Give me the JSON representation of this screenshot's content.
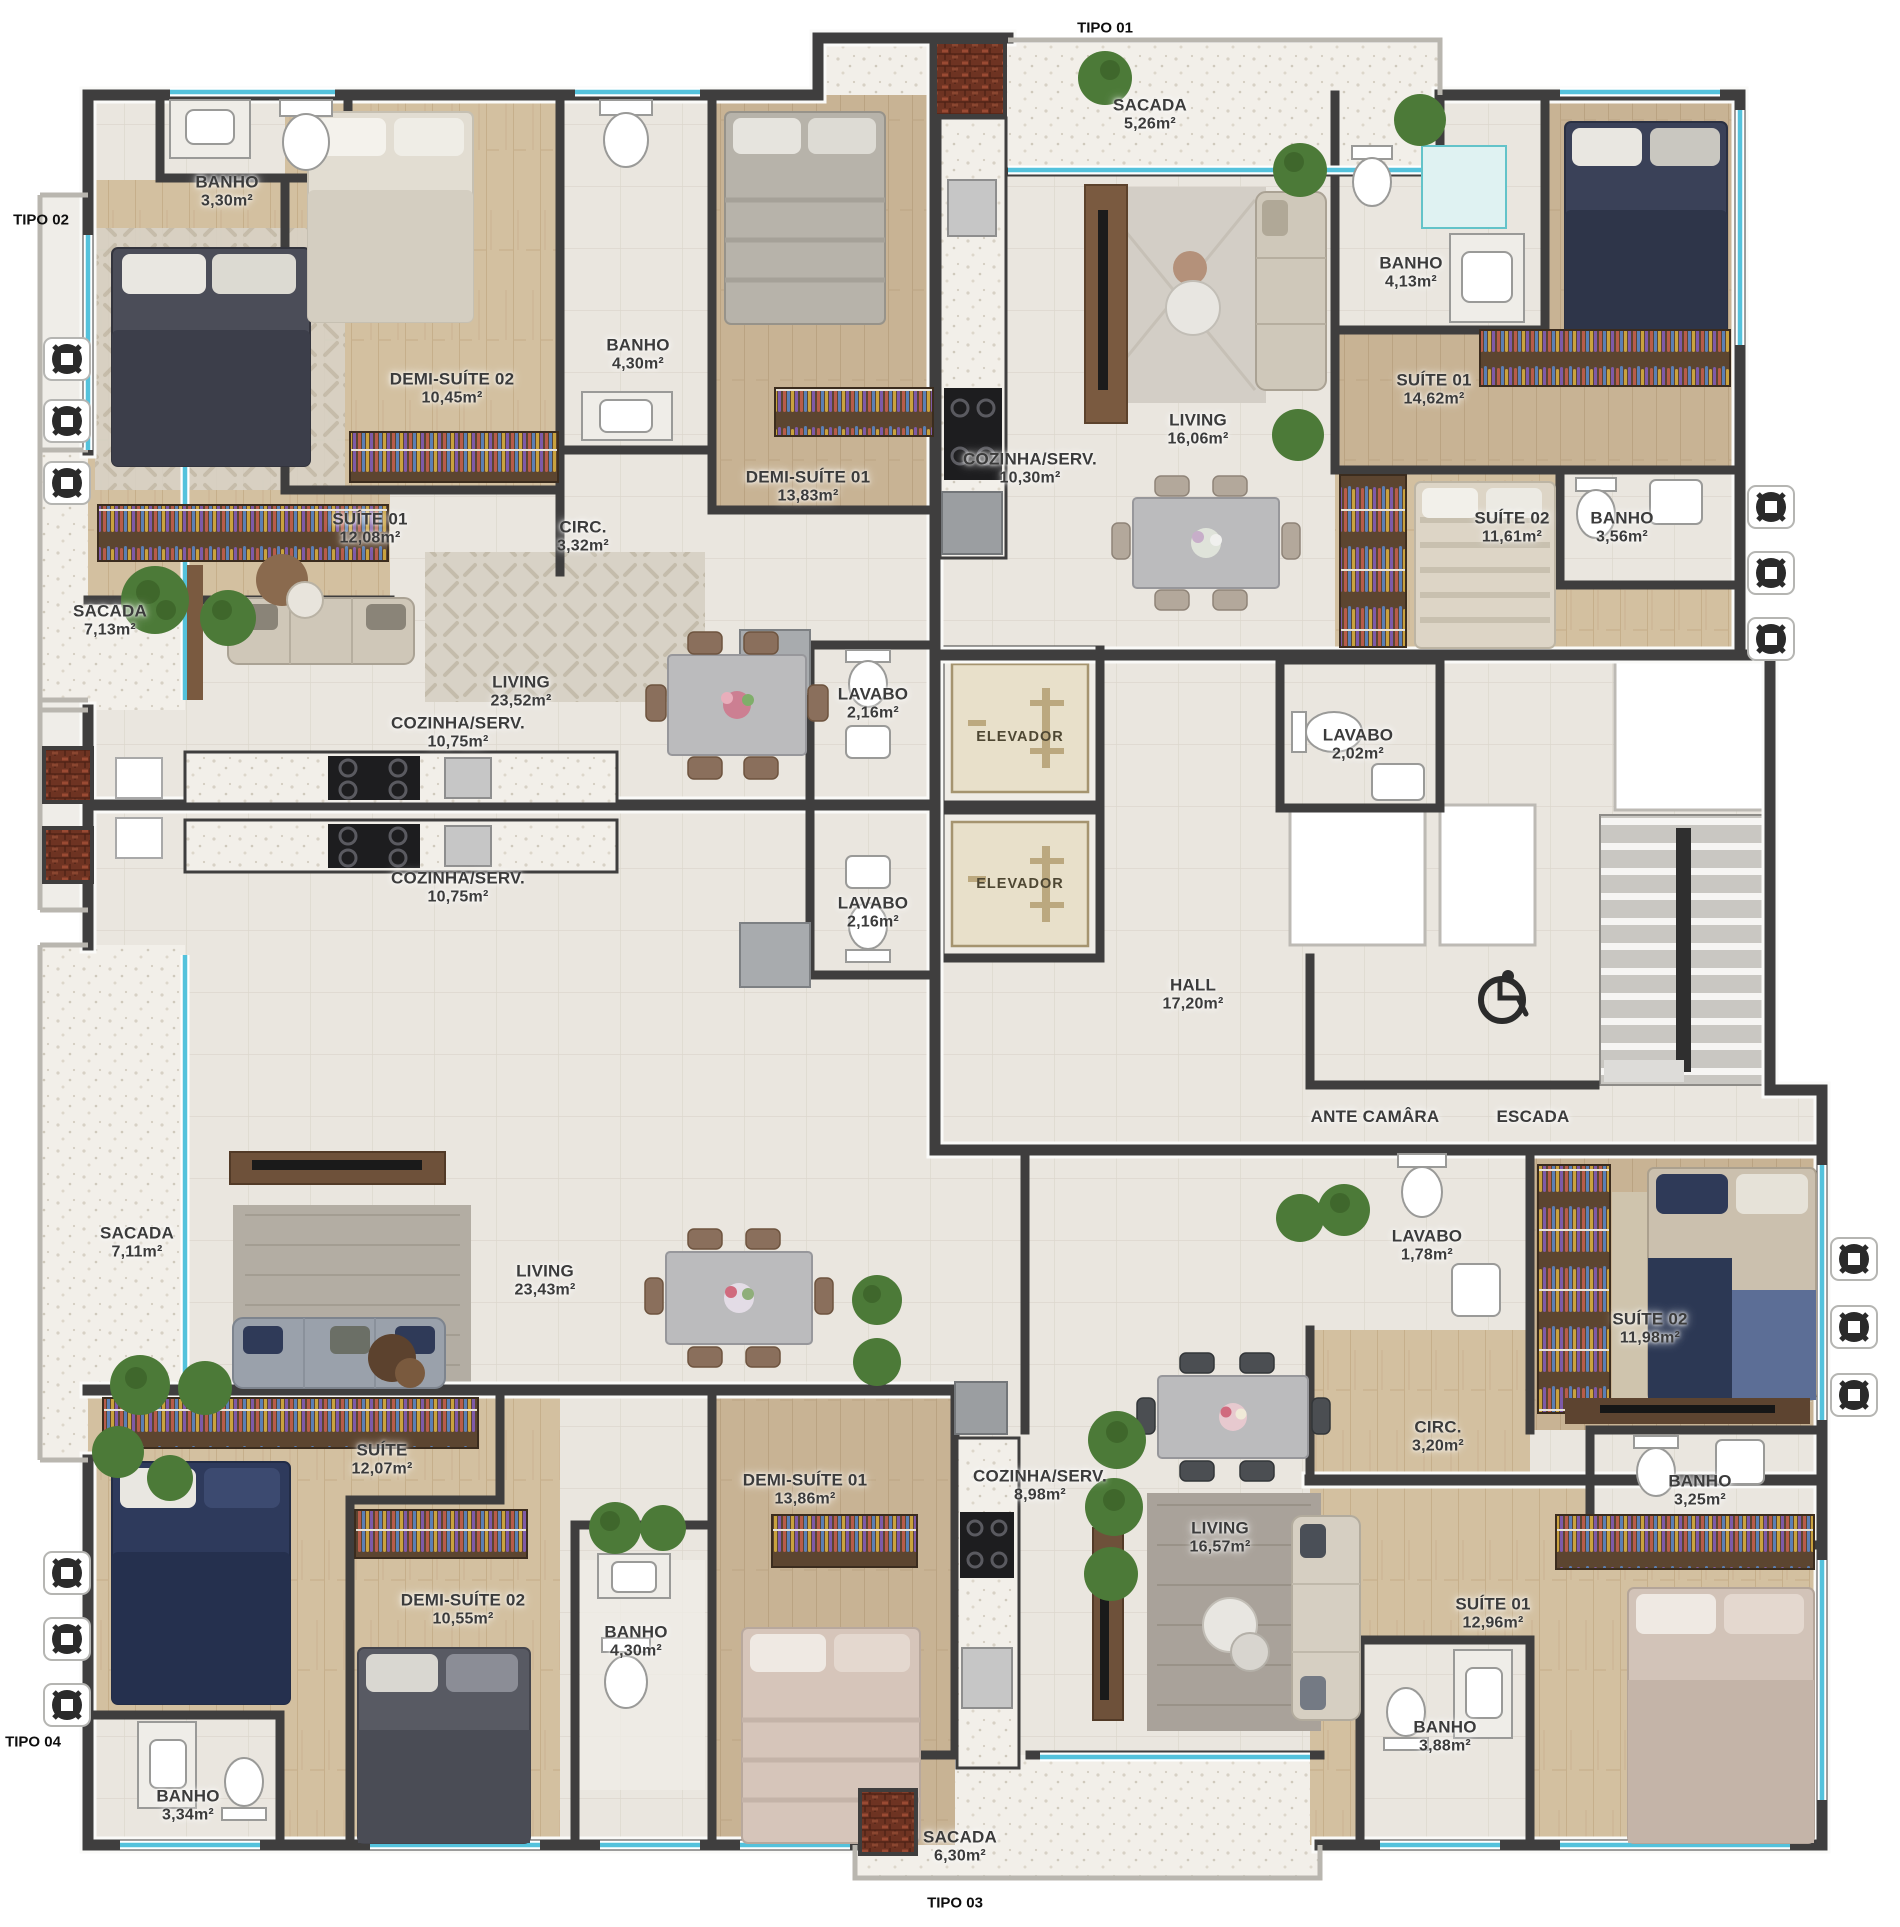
{
  "title": "Planta do pavimento - apartamentos Tipo 01 a Tipo 04",
  "colors": {
    "wall": "#3f3e3e",
    "tile_floor": "#eae6df",
    "wood_floor": "#d3c0a0",
    "balcony_floor": "#f2efe9",
    "window_glass": "#54c2dc",
    "label_text": "#3b3b3b",
    "elevator_cab": "#e8e0ca",
    "plant_green": "#4c7a38",
    "void_white": "#ffffff"
  },
  "tipo_labels": [
    {
      "label": "TIPO 01",
      "x": 1105,
      "y": 28
    },
    {
      "label": "TIPO 02",
      "x": 41,
      "y": 220
    },
    {
      "label": "TIPO 03",
      "x": 955,
      "y": 1903
    },
    {
      "label": "TIPO 04",
      "x": 33,
      "y": 1742
    }
  ],
  "rooms": [
    {
      "name": "BANHO",
      "area": "3,30m²",
      "x": 227,
      "y": 192
    },
    {
      "name": "DEMI-SUÍTE 02",
      "area": "10,45m²",
      "x": 452,
      "y": 389
    },
    {
      "name": "BANHO",
      "area": "4,30m²",
      "x": 638,
      "y": 355
    },
    {
      "name": "DEMI-SUÍTE 01",
      "area": "13,83m²",
      "x": 808,
      "y": 487
    },
    {
      "name": "SUÍTE 01",
      "area": "12,08m²",
      "x": 370,
      "y": 529
    },
    {
      "name": "CIRC.",
      "area": "3,32m²",
      "x": 583,
      "y": 537
    },
    {
      "name": "LIVING",
      "area": "23,52m²",
      "x": 521,
      "y": 692
    },
    {
      "name": "SACADA",
      "area": "7,13m²",
      "x": 110,
      "y": 621
    },
    {
      "name": "COZINHA/SERV.",
      "area": "10,75m²",
      "x": 458,
      "y": 733
    },
    {
      "name": "LAVABO",
      "area": "2,16m²",
      "x": 873,
      "y": 704
    },
    {
      "name": "SACADA",
      "area": "5,26m²",
      "x": 1150,
      "y": 115
    },
    {
      "name": "COZINHA/SERV.",
      "area": "10,30m²",
      "x": 1030,
      "y": 469
    },
    {
      "name": "LIVING",
      "area": "16,06m²",
      "x": 1198,
      "y": 430
    },
    {
      "name": "BANHO",
      "area": "4,13m²",
      "x": 1411,
      "y": 273
    },
    {
      "name": "SUÍTE 01",
      "area": "14,62m²",
      "x": 1434,
      "y": 390
    },
    {
      "name": "SUÍTE 02",
      "area": "11,61m²",
      "x": 1512,
      "y": 528
    },
    {
      "name": "BANHO",
      "area": "3,56m²",
      "x": 1622,
      "y": 528
    },
    {
      "name": "LAVABO",
      "area": "2,02m²",
      "x": 1358,
      "y": 745
    },
    {
      "name": "HALL",
      "area": "17,20m²",
      "x": 1193,
      "y": 995
    },
    {
      "name": "ANTE CAMÂRA",
      "area": "",
      "x": 1375,
      "y": 1117
    },
    {
      "name": "ESCADA",
      "area": "",
      "x": 1533,
      "y": 1117
    },
    {
      "name": "COZINHA/SERV.",
      "area": "10,75m²",
      "x": 458,
      "y": 888
    },
    {
      "name": "LAVABO",
      "area": "2,16m²",
      "x": 873,
      "y": 913
    },
    {
      "name": "LIVING",
      "area": "23,43m²",
      "x": 545,
      "y": 1281
    },
    {
      "name": "SACADA",
      "area": "7,11m²",
      "x": 137,
      "y": 1243
    },
    {
      "name": "SUÍTE",
      "area": "12,07m²",
      "x": 382,
      "y": 1460
    },
    {
      "name": "DEMI-SUÍTE 02",
      "area": "10,55m²",
      "x": 463,
      "y": 1610
    },
    {
      "name": "BANHO",
      "area": "4,30m²",
      "x": 636,
      "y": 1642
    },
    {
      "name": "DEMI-SUÍTE 01",
      "area": "13,86m²",
      "x": 805,
      "y": 1490
    },
    {
      "name": "BANHO",
      "area": "3,34m²",
      "x": 188,
      "y": 1806
    },
    {
      "name": "COZINHA/SERV.",
      "area": "8,98m²",
      "x": 1040,
      "y": 1486
    },
    {
      "name": "LIVING",
      "area": "16,57m²",
      "x": 1220,
      "y": 1538
    },
    {
      "name": "LAVABO",
      "area": "1,78m²",
      "x": 1427,
      "y": 1246
    },
    {
      "name": "CIRC.",
      "area": "3,20m²",
      "x": 1438,
      "y": 1437
    },
    {
      "name": "SUÍTE 02",
      "area": "11,98m²",
      "x": 1650,
      "y": 1329
    },
    {
      "name": "BANHO",
      "area": "3,25m²",
      "x": 1700,
      "y": 1491
    },
    {
      "name": "SUÍTE 01",
      "area": "12,96m²",
      "x": 1493,
      "y": 1614
    },
    {
      "name": "BANHO",
      "area": "3,88m²",
      "x": 1445,
      "y": 1737
    },
    {
      "name": "SACADA",
      "area": "6,30m²",
      "x": 960,
      "y": 1847
    }
  ],
  "elevators": [
    {
      "label": "ELEVADOR",
      "x": 1020,
      "y": 737
    },
    {
      "label": "ELEVADOR",
      "x": 1020,
      "y": 884
    }
  ]
}
